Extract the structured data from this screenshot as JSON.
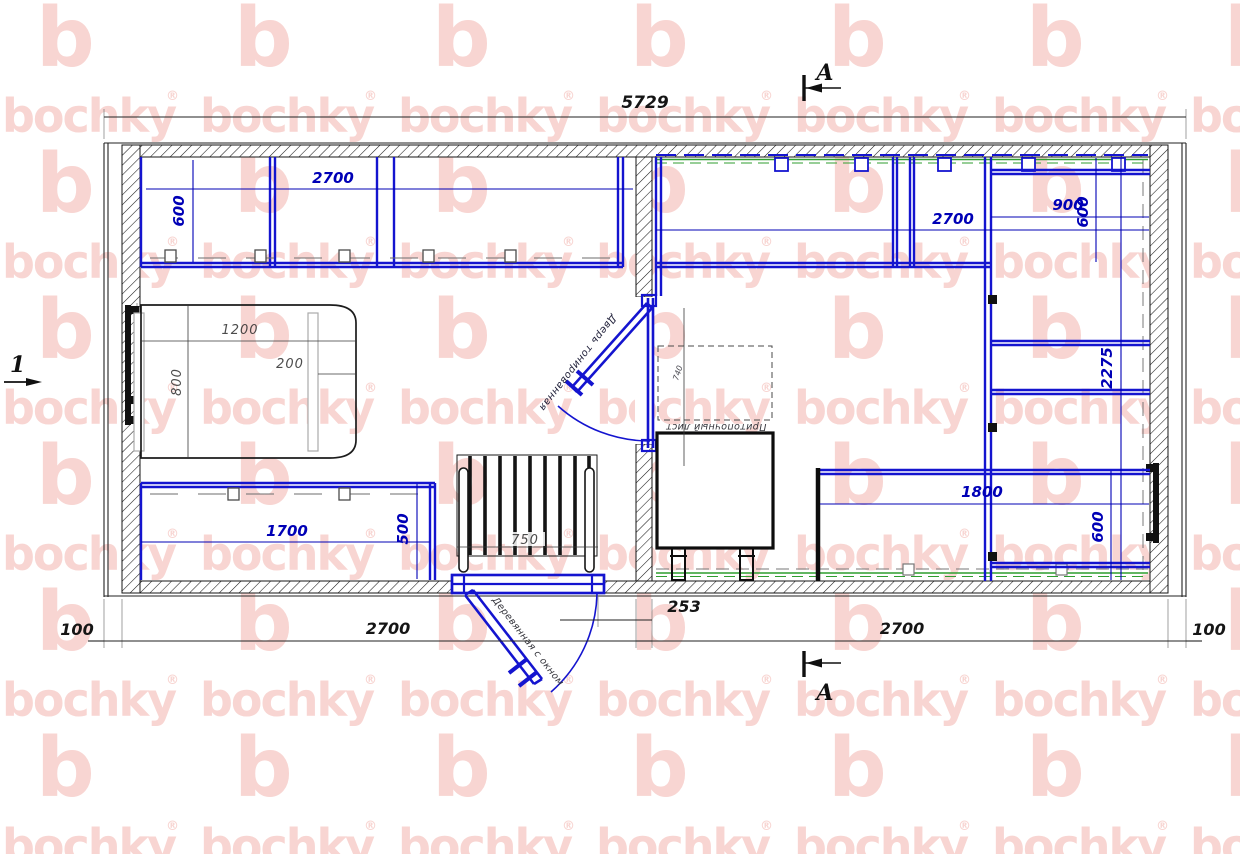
{
  "title": "bochky sauna floor plan",
  "watermark": {
    "letter": "b",
    "word": "bochky",
    "reg": "®",
    "color": "#f8d5d2"
  },
  "colors": {
    "furniture_blue": "#1414cf",
    "dimension_blue": "#0000b6",
    "wall_black": "#161616",
    "floor_green": "#2f9e2f",
    "watermark_pink": "#f8d5d2"
  },
  "dims": {
    "overall": "5729",
    "chain_left100": "100",
    "chain_left2700": "2700",
    "chain_253": "253",
    "chain_right2700": "2700",
    "chain_right100": "100",
    "lt_bench_w": "2700",
    "lt_bench_d": "600",
    "table_w": "1200",
    "table_d": "800",
    "table_off": "200",
    "lb_bench_w": "1700",
    "lb_bench_d": "500",
    "entry_door_w": "750",
    "rt_bench_w": "2700",
    "rt_bench_d": "600",
    "rt_side_w": "900",
    "room_len": "2275",
    "rb_bench_w": "1800",
    "rb_bench_d": "600",
    "sheet_dim": "740"
  },
  "labels": {
    "section": "А",
    "view": "1",
    "entry_door": "Деревянная с окном",
    "inner_door": "Дверь тонированная",
    "stove_sheet": "Притопочный лист"
  }
}
